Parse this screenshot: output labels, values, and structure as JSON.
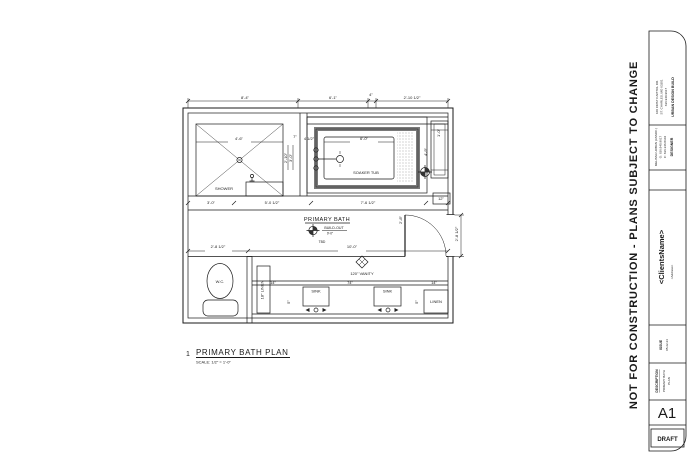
{
  "titleblock": {
    "warning": "NOT FOR CONSTRUCTION   -   PLANS SUBJECT TO CHANGE",
    "company": {
      "name": "URBAN DESIGN BUILD",
      "line1": "100 FIRST CAPITOL DR.",
      "line2": "ST. CHARLES, MO 63301",
      "line3": "636.940.9617"
    },
    "designer": {
      "label": "DESIGNER",
      "line1": "MELISSA URBAN (ASSOC.)",
      "line2": "O: 636.940.9617",
      "line3": "C: 636.346.8104"
    },
    "client": {
      "name": "<ClientsName>",
      "address": "<Address>"
    },
    "issue": {
      "label": "ISSUE",
      "date": "05.22.24"
    },
    "description": {
      "label": "DESCRIPTION",
      "line1": "PRIMARY BATH",
      "line2": "PLAN"
    },
    "sheet_number": "A1",
    "status": "DRAFT"
  },
  "drawing_title": {
    "number": "1",
    "name": "PRIMARY BATH PLAN",
    "scale": "SCALE: 1/2\" = 1'-0\""
  },
  "plan": {
    "room": {
      "label": "PRIMARY BATH",
      "elev_label": "BUILD-OUT",
      "elev_value": "9'-0\"",
      "note": "TBD"
    },
    "fixtures": {
      "shower": "SHOWER",
      "tub": "SOAKER TUB",
      "wc": "W.C.",
      "sink1": "SINK",
      "sink2": "SINK",
      "vanity": "120\" VANITY",
      "linen_tall": "18\" LINEN",
      "linen": "LINEN",
      "cabinet_dim": "12\""
    },
    "dimensions": [
      {
        "t": "8'-4\"",
        "x": 245,
        "y": 99
      },
      {
        "t": "6'-1\"",
        "x": 333,
        "y": 99
      },
      {
        "t": "4\"",
        "x": 371,
        "y": 96,
        "s": 3.2
      },
      {
        "t": "2'-10 1/2\"",
        "x": 412,
        "y": 99
      },
      {
        "t": "4'-6\"",
        "x": 239,
        "y": 140,
        "s": 3.5
      },
      {
        "t": "7\"",
        "x": 295,
        "y": 138,
        "s": 3
      },
      {
        "t": "4 1/2\"",
        "x": 309,
        "y": 140,
        "s": 3
      },
      {
        "t": "2'-10\"",
        "x": 287,
        "y": 158,
        "r": -90,
        "s": 3
      },
      {
        "t": "3'-0\"",
        "x": 292,
        "y": 158,
        "r": -90,
        "s": 3
      },
      {
        "t": "6'-0\"",
        "x": 364,
        "y": 140,
        "s": 3.5
      },
      {
        "t": "4'-9\"",
        "x": 427,
        "y": 152,
        "r": -90,
        "s": 3
      },
      {
        "t": "1'-0\"",
        "x": 440,
        "y": 133,
        "r": -90,
        "s": 3
      },
      {
        "t": "3'-0\"",
        "x": 211,
        "y": 204,
        "s": 3.5
      },
      {
        "t": "5'-0 1/2\"",
        "x": 272,
        "y": 204,
        "s": 3.5
      },
      {
        "t": "7'-6 1/2\"",
        "x": 368,
        "y": 204,
        "s": 3.5
      },
      {
        "t": "2'-8 1/2\"",
        "x": 218,
        "y": 248,
        "s": 3.5
      },
      {
        "t": "10'-0\"",
        "x": 352,
        "y": 248,
        "s": 3.5
      },
      {
        "t": "2'-8\"",
        "x": 402,
        "y": 220,
        "r": -90,
        "s": 3
      },
      {
        "t": "2'-8 1/2\"",
        "x": 458,
        "y": 234,
        "r": -90,
        "s": 3
      },
      {
        "t": "14\"",
        "x": 273,
        "y": 284,
        "s": 3
      },
      {
        "t": "74\"",
        "x": 350,
        "y": 284,
        "s": 3
      },
      {
        "t": "14\"",
        "x": 434,
        "y": 284,
        "s": 3
      },
      {
        "t": "5\"",
        "x": 290,
        "y": 302,
        "r": -90,
        "s": 3
      },
      {
        "t": "5\"",
        "x": 418,
        "y": 302,
        "r": -90,
        "s": 3
      },
      {
        "t": "12\"",
        "x": 441,
        "y": 200,
        "s": 3
      }
    ]
  }
}
